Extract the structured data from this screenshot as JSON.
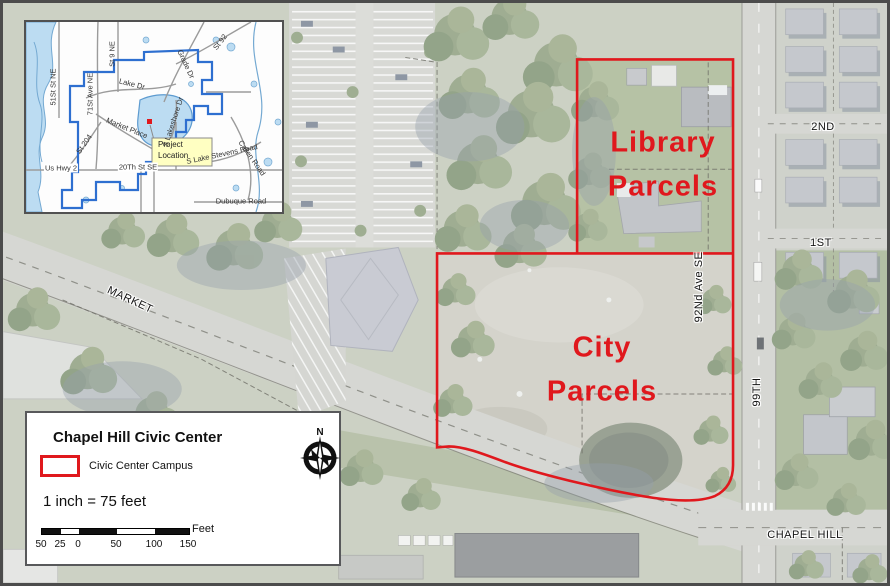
{
  "map": {
    "parcel_labels": {
      "library_line1": "Library",
      "library_line2": "Parcels",
      "city_line1": "City",
      "city_line2": "Parcels"
    },
    "streets": {
      "market": "MARKET",
      "second": "2ND",
      "first": "1ST",
      "ninety_second_ave": "92Nd Ave SE",
      "ninety_ninth": "99TH",
      "chapel_hill": "CHAPEL HILL"
    }
  },
  "inset": {
    "callout": {
      "line1": "Project",
      "line2": "Location"
    },
    "streets": {
      "st51": "51St St NE",
      "ave71": "71St Ave NE",
      "st9": "St 9 NE",
      "st92": "St 92",
      "lake_dr": "Lake Dr",
      "grade_dr": "Grade Dr",
      "market_place": "Market Place",
      "s_lakeshore": "S Lakeshore Dr",
      "s_lake_stevens": "S Lake Stevens Road",
      "st204": "St 204",
      "us_hwy2": "Us Hwy 2",
      "twentieth": "20Th St SE",
      "callen": "Callen Road",
      "dubuque": "Dubuque Road"
    }
  },
  "legend": {
    "title": "Chapel Hill Civic Center",
    "swatch_label": "Civic Center Campus",
    "scale_text": "1 inch = 75 feet",
    "scale_bar": {
      "ticks": [
        "50",
        "25",
        "0",
        "50",
        "100",
        "150"
      ],
      "unit": "Feet"
    },
    "north_label": "N"
  },
  "colors": {
    "boundary_red": "#e0181d",
    "inset_boundary_blue": "#2e6fd0",
    "water_blue": "#bcdcf2",
    "road_gray": "#d6d7d3"
  }
}
